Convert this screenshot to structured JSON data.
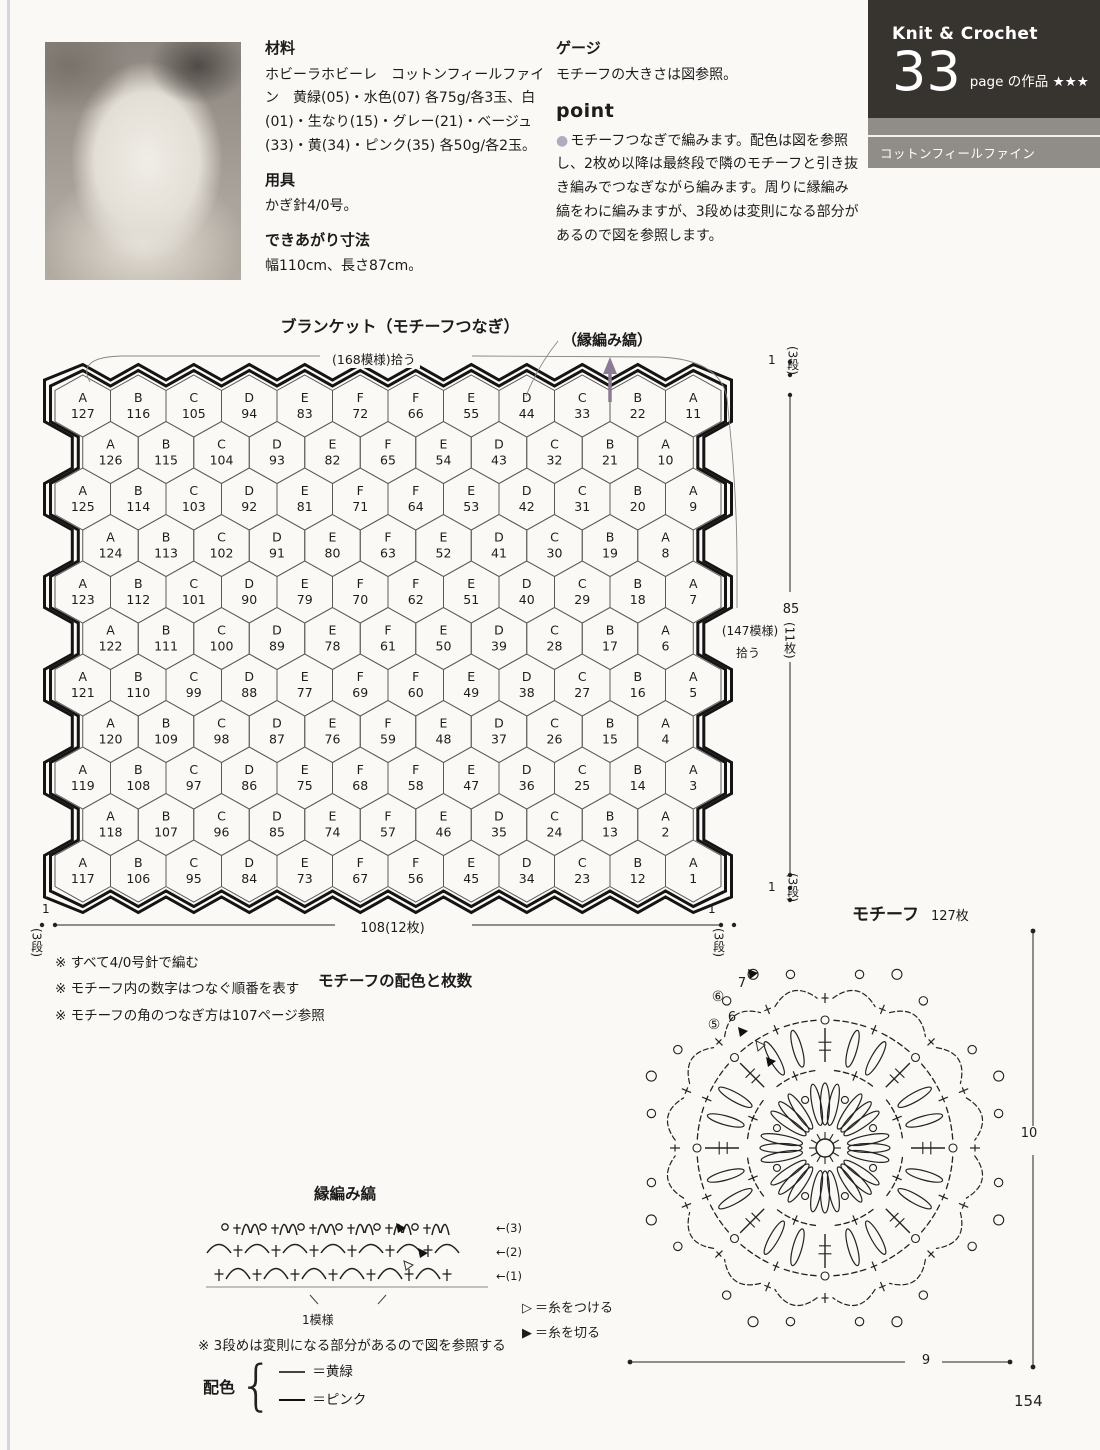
{
  "page_number": "154",
  "header": {
    "series": "Knit & Crochet",
    "big_num": "33",
    "sub_label": "page の作品 ★★★",
    "band": "コットンフィールファイン"
  },
  "info": {
    "materials_heading": "材料",
    "materials_body": "ホビーラホビーレ　コットンフィールファイン　黄緑(05)・水色(07) 各75g/各3玉、白(01)・生なり(15)・グレー(21)・ベージュ(33)・黄(34)・ピンク(35) 各50g/各2玉。",
    "tools_heading": "用具",
    "tools_body": "かぎ針4/0号。",
    "size_heading": "できあがり寸法",
    "size_body": "幅110cm、長さ87cm。",
    "gauge_heading": "ゲージ",
    "gauge_body": "モチーフの大きさは図参照。",
    "point_heading": "point",
    "point_bullet": "●",
    "point_body": "モチーフつなぎで編みます。配色は図を参照し、2枚め以降は最終段で隣のモチーフと引き抜き編みでつなぎながら編みます。周りに縁編み縞をわに編みますが、3段めは変則になる部分があるので図を参照します。"
  },
  "blanket": {
    "title": "ブランケット（モチーフつなぎ）",
    "pickup_top": "(168模様)拾う",
    "edging_callout": "（縁編み縞）",
    "pickup_right_line1": "(147模様)",
    "pickup_right_line2": "拾う",
    "dim_width": "108(12枚)",
    "dim_height": "85",
    "dim_height_sub": "(11枚)",
    "edge_num": "1",
    "edge_rows": "(3段)",
    "grid": [
      [
        "A127",
        "B116",
        "C105",
        "D94",
        "E83",
        "F72",
        "F66",
        "E55",
        "D44",
        "C33",
        "B22",
        "A11"
      ],
      [
        "A126",
        "B115",
        "C104",
        "D93",
        "E82",
        "F65",
        "E54",
        "D43",
        "C32",
        "B21",
        "A10"
      ],
      [
        "A125",
        "B114",
        "C103",
        "D92",
        "E81",
        "F71",
        "F64",
        "E53",
        "D42",
        "C31",
        "B20",
        "A9"
      ],
      [
        "A124",
        "B113",
        "C102",
        "D91",
        "E80",
        "F63",
        "E52",
        "D41",
        "C30",
        "B19",
        "A8"
      ],
      [
        "A123",
        "B112",
        "C101",
        "D90",
        "E79",
        "F70",
        "F62",
        "E51",
        "D40",
        "C29",
        "B18",
        "A7"
      ],
      [
        "A122",
        "B111",
        "C100",
        "D89",
        "E78",
        "F61",
        "E50",
        "D39",
        "C28",
        "B17",
        "A6"
      ],
      [
        "A121",
        "B110",
        "C99",
        "D88",
        "E77",
        "F69",
        "F60",
        "E49",
        "D38",
        "C27",
        "B16",
        "A5"
      ],
      [
        "A120",
        "B109",
        "C98",
        "D87",
        "E76",
        "F59",
        "E48",
        "D37",
        "C26",
        "B15",
        "A4"
      ],
      [
        "A119",
        "B108",
        "C97",
        "D86",
        "E75",
        "F68",
        "F58",
        "E47",
        "D36",
        "C25",
        "B14",
        "A3"
      ],
      [
        "A118",
        "B107",
        "C96",
        "D85",
        "E74",
        "F57",
        "E46",
        "D35",
        "C24",
        "B13",
        "A2"
      ],
      [
        "A117",
        "B106",
        "C95",
        "D84",
        "E73",
        "F67",
        "F56",
        "E45",
        "D34",
        "C23",
        "B12",
        "A1"
      ]
    ]
  },
  "notes": [
    "※ すべて4/0号針で編む",
    "※ モチーフ内の数字はつなぐ順番を表す",
    "※ モチーフの角のつなぎ方は107ページ参照"
  ],
  "color_table": {
    "title": "モチーフの配色と枚数",
    "headers": [
      "",
      "1、2段め",
      "3段め",
      "4段め",
      "5、6段め",
      "枚数"
    ],
    "rows": [
      [
        "A",
        "白",
        "黄緑",
        "ピンク",
        "グレー",
        "22枚"
      ],
      [
        "B",
        "生なり",
        "グレー",
        "水色",
        "黄緑",
        "22枚"
      ],
      [
        "C",
        "生なり",
        "グレー",
        "黄緑",
        "水色",
        "22枚"
      ],
      [
        "D",
        "白",
        "水色",
        "黄",
        "ベージュ",
        "22枚"
      ],
      [
        "E",
        "白",
        "水色",
        "ベージュ",
        "黄",
        "22枚"
      ],
      [
        "F",
        "水色",
        "生なり",
        "白",
        "生なり",
        "17枚"
      ]
    ]
  },
  "edging": {
    "title": "縁編み縞",
    "row_labels": [
      "←(3)",
      "←(2)",
      "←(1)"
    ],
    "pattern_label": "1模様",
    "note": "※ 3段めは変則になる部分があるので図を参照する",
    "colors_label": "配色",
    "colors": [
      {
        "label": "＝黄緑"
      },
      {
        "label": "＝ピンク"
      }
    ]
  },
  "motif": {
    "title": "モチーフ",
    "count": "127枚",
    "dim_width": "9",
    "dim_height": "10",
    "legend": [
      {
        "symbol": "▷",
        "label": "＝糸をつける"
      },
      {
        "symbol": "▶",
        "label": "＝糸を切る"
      }
    ],
    "annotations": [
      "⑥",
      "7",
      "6",
      "⑤"
    ]
  }
}
